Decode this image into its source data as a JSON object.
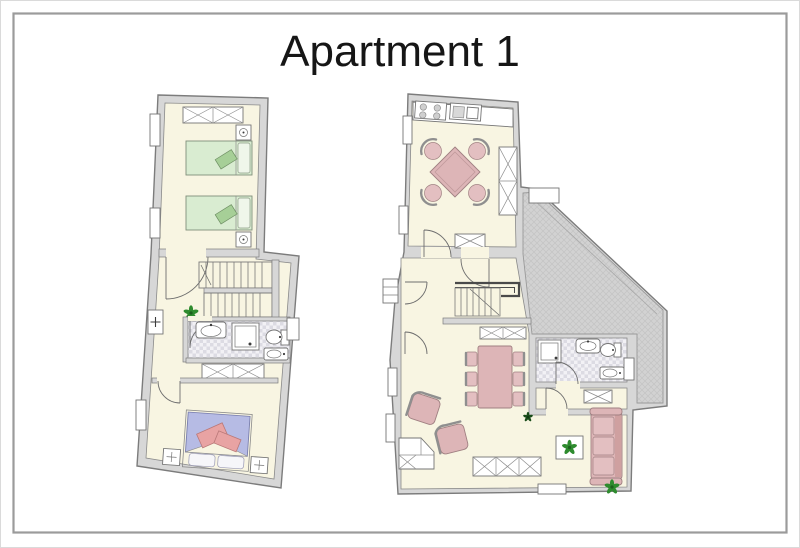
{
  "title": "Apartment 1",
  "colors": {
    "background": "#ffffff",
    "frame_border": "#9b9b9b",
    "edge_border": "#dadada",
    "title_color": "#161616",
    "wall": "#d7d7d7",
    "wall_stroke": "#7c7c7c",
    "floor": "#f8f5e2",
    "floor_stroke": "#8a8a8a",
    "tile_a": "#f2f1f5",
    "tile_b": "#dcdbe3",
    "terrace": "#d2d2d2",
    "terrace_line": "#c3c3c3",
    "fixture": "#ffffff",
    "fixture_stroke": "#757575",
    "bed_green": "#d9ecd1",
    "bed_green_dark": "#a6cf97",
    "bed_green_pillow": "#eff6ea",
    "bed_blue": "#b6bbe4",
    "pillow_white": "#f6f6f9",
    "blanket_pink": "#e8a3a3",
    "blanket_pink_stroke": "#b97878",
    "pink": "#ddb5b7",
    "pink_light": "#e3bfc1",
    "pink_stroke": "#a08082",
    "chair_back": "#8f8f8f",
    "plant": "#2e8b2e",
    "plant_dark": "#1d611d",
    "stair_rail": "#4a4a4a",
    "burner": "#cfcfcf"
  },
  "floorplans": [
    {
      "id": "left-floor",
      "rooms": [
        "twin-bedroom",
        "hallway-with-stairs",
        "bathroom",
        "double-bedroom"
      ],
      "furniture": [
        "wardrobe",
        "single-bed",
        "single-bed",
        "nightstand-lamp",
        "nightstand-lamp",
        "staircase",
        "plant",
        "washbasin",
        "shower",
        "toilet",
        "bidet",
        "wardrobe",
        "double-bed",
        "nightstand-lamp",
        "nightstand-lamp",
        "radiator"
      ]
    },
    {
      "id": "right-floor",
      "rooms": [
        "kitchen-dining-room",
        "hallway-with-stairs",
        "bathroom",
        "storage-room",
        "living-room",
        "terrace"
      ],
      "furniture": [
        "kitchen-counter",
        "stove",
        "kitchen-sink",
        "square-dining-table",
        "chair",
        "chair",
        "chair",
        "chair",
        "tall-cabinet",
        "cabinet",
        "staircase",
        "under-stair-cabinet",
        "shower",
        "washbasin",
        "toilet",
        "bidet",
        "long-dining-table",
        "dining-chairs",
        "armchair",
        "armchair",
        "corner-unit",
        "sideboard",
        "coffee-table",
        "sofa",
        "plant",
        "plant",
        "plant"
      ]
    }
  ]
}
